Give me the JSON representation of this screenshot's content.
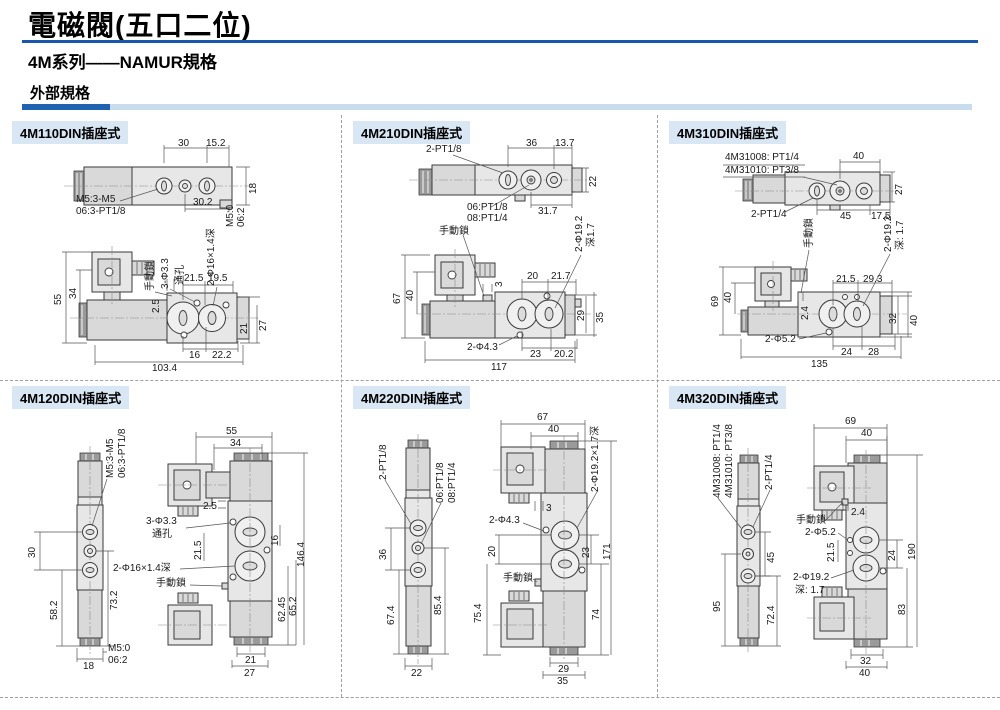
{
  "page": {
    "title": "電磁閥(五口二位)",
    "subtitle": "4M系列——NAMUR規格",
    "section": "外部規格"
  },
  "colors": {
    "rule_blue": "#1b57a8",
    "bar_dark_blue": "#1e62b0",
    "bar_light_blue": "#c9dcee",
    "panel_title_bg": "#d9e7f5"
  },
  "panels": [
    {
      "title": "4M110DIN插座式",
      "labels": [
        "30",
        "15.2",
        "18",
        "30.2",
        "M5:3-M5",
        "06:3-PT1/8",
        "M5:0",
        "06:2",
        "55",
        "34",
        "手動鎖",
        "3-Φ3.3",
        "通孔",
        "2-Φ16×1.4深",
        "21.5",
        "19.5",
        "2.5",
        "21",
        "27",
        "16",
        "22.2",
        "103.4"
      ]
    },
    {
      "title": "4M210DIN插座式",
      "labels": [
        "2-PT1/8",
        "36",
        "13.7",
        "22",
        "06:PT1/8",
        "08:PT1/4",
        "31.7",
        "手動鎖",
        "67",
        "40",
        "3",
        "20",
        "21.7",
        "2-Φ19.2",
        "深1.7",
        "29",
        "35",
        "2-Φ4.3",
        "23",
        "20.2",
        "117"
      ]
    },
    {
      "title": "4M310DIN插座式",
      "labels": [
        "4M31008: PT1/4",
        "4M31010: PT3/8",
        "40",
        "27",
        "2-PT1/4",
        "45",
        "17.5",
        "手動鎖",
        "69",
        "40",
        "2.4",
        "21.5",
        "29.3",
        "2-Φ19.2",
        "深: 1.7",
        "32",
        "40",
        "2-Φ5.2",
        "24",
        "28",
        "135"
      ]
    },
    {
      "title": "4M120DIN插座式",
      "labels": [
        "M5:3-M5",
        "06:3-PT1/8",
        "30",
        "58.2",
        "73.2",
        "18",
        "M5:0",
        "06:2",
        "55",
        "34",
        "2.5",
        "3-Φ3.3",
        "通孔",
        "21.5",
        "2-Φ16×1.4深",
        "手動鎖",
        "16",
        "146.4",
        "62.45",
        "65.2",
        "21",
        "27"
      ]
    },
    {
      "title": "4M220DIN插座式",
      "labels": [
        "2-PT1/8",
        "06:PT1/8",
        "08:PT1/4",
        "36",
        "67.4",
        "85.4",
        "22",
        "67",
        "40",
        "3",
        "2-Φ4.3",
        "2-Φ19.2×1.7深",
        "20",
        "手動鎖",
        "23",
        "171",
        "74",
        "75.4",
        "29",
        "35"
      ]
    },
    {
      "title": "4M320DIN插座式",
      "labels": [
        "4M31008: PT1/4",
        "4M31010: PT3/8",
        "2-PT1/4",
        "45",
        "95",
        "72.4",
        "69",
        "40",
        "2.4",
        "手動鎖",
        "2-Φ5.2",
        "21.5",
        "2-Φ19.2",
        "深: 1.7",
        "24",
        "190",
        "83",
        "32",
        "40"
      ]
    }
  ]
}
